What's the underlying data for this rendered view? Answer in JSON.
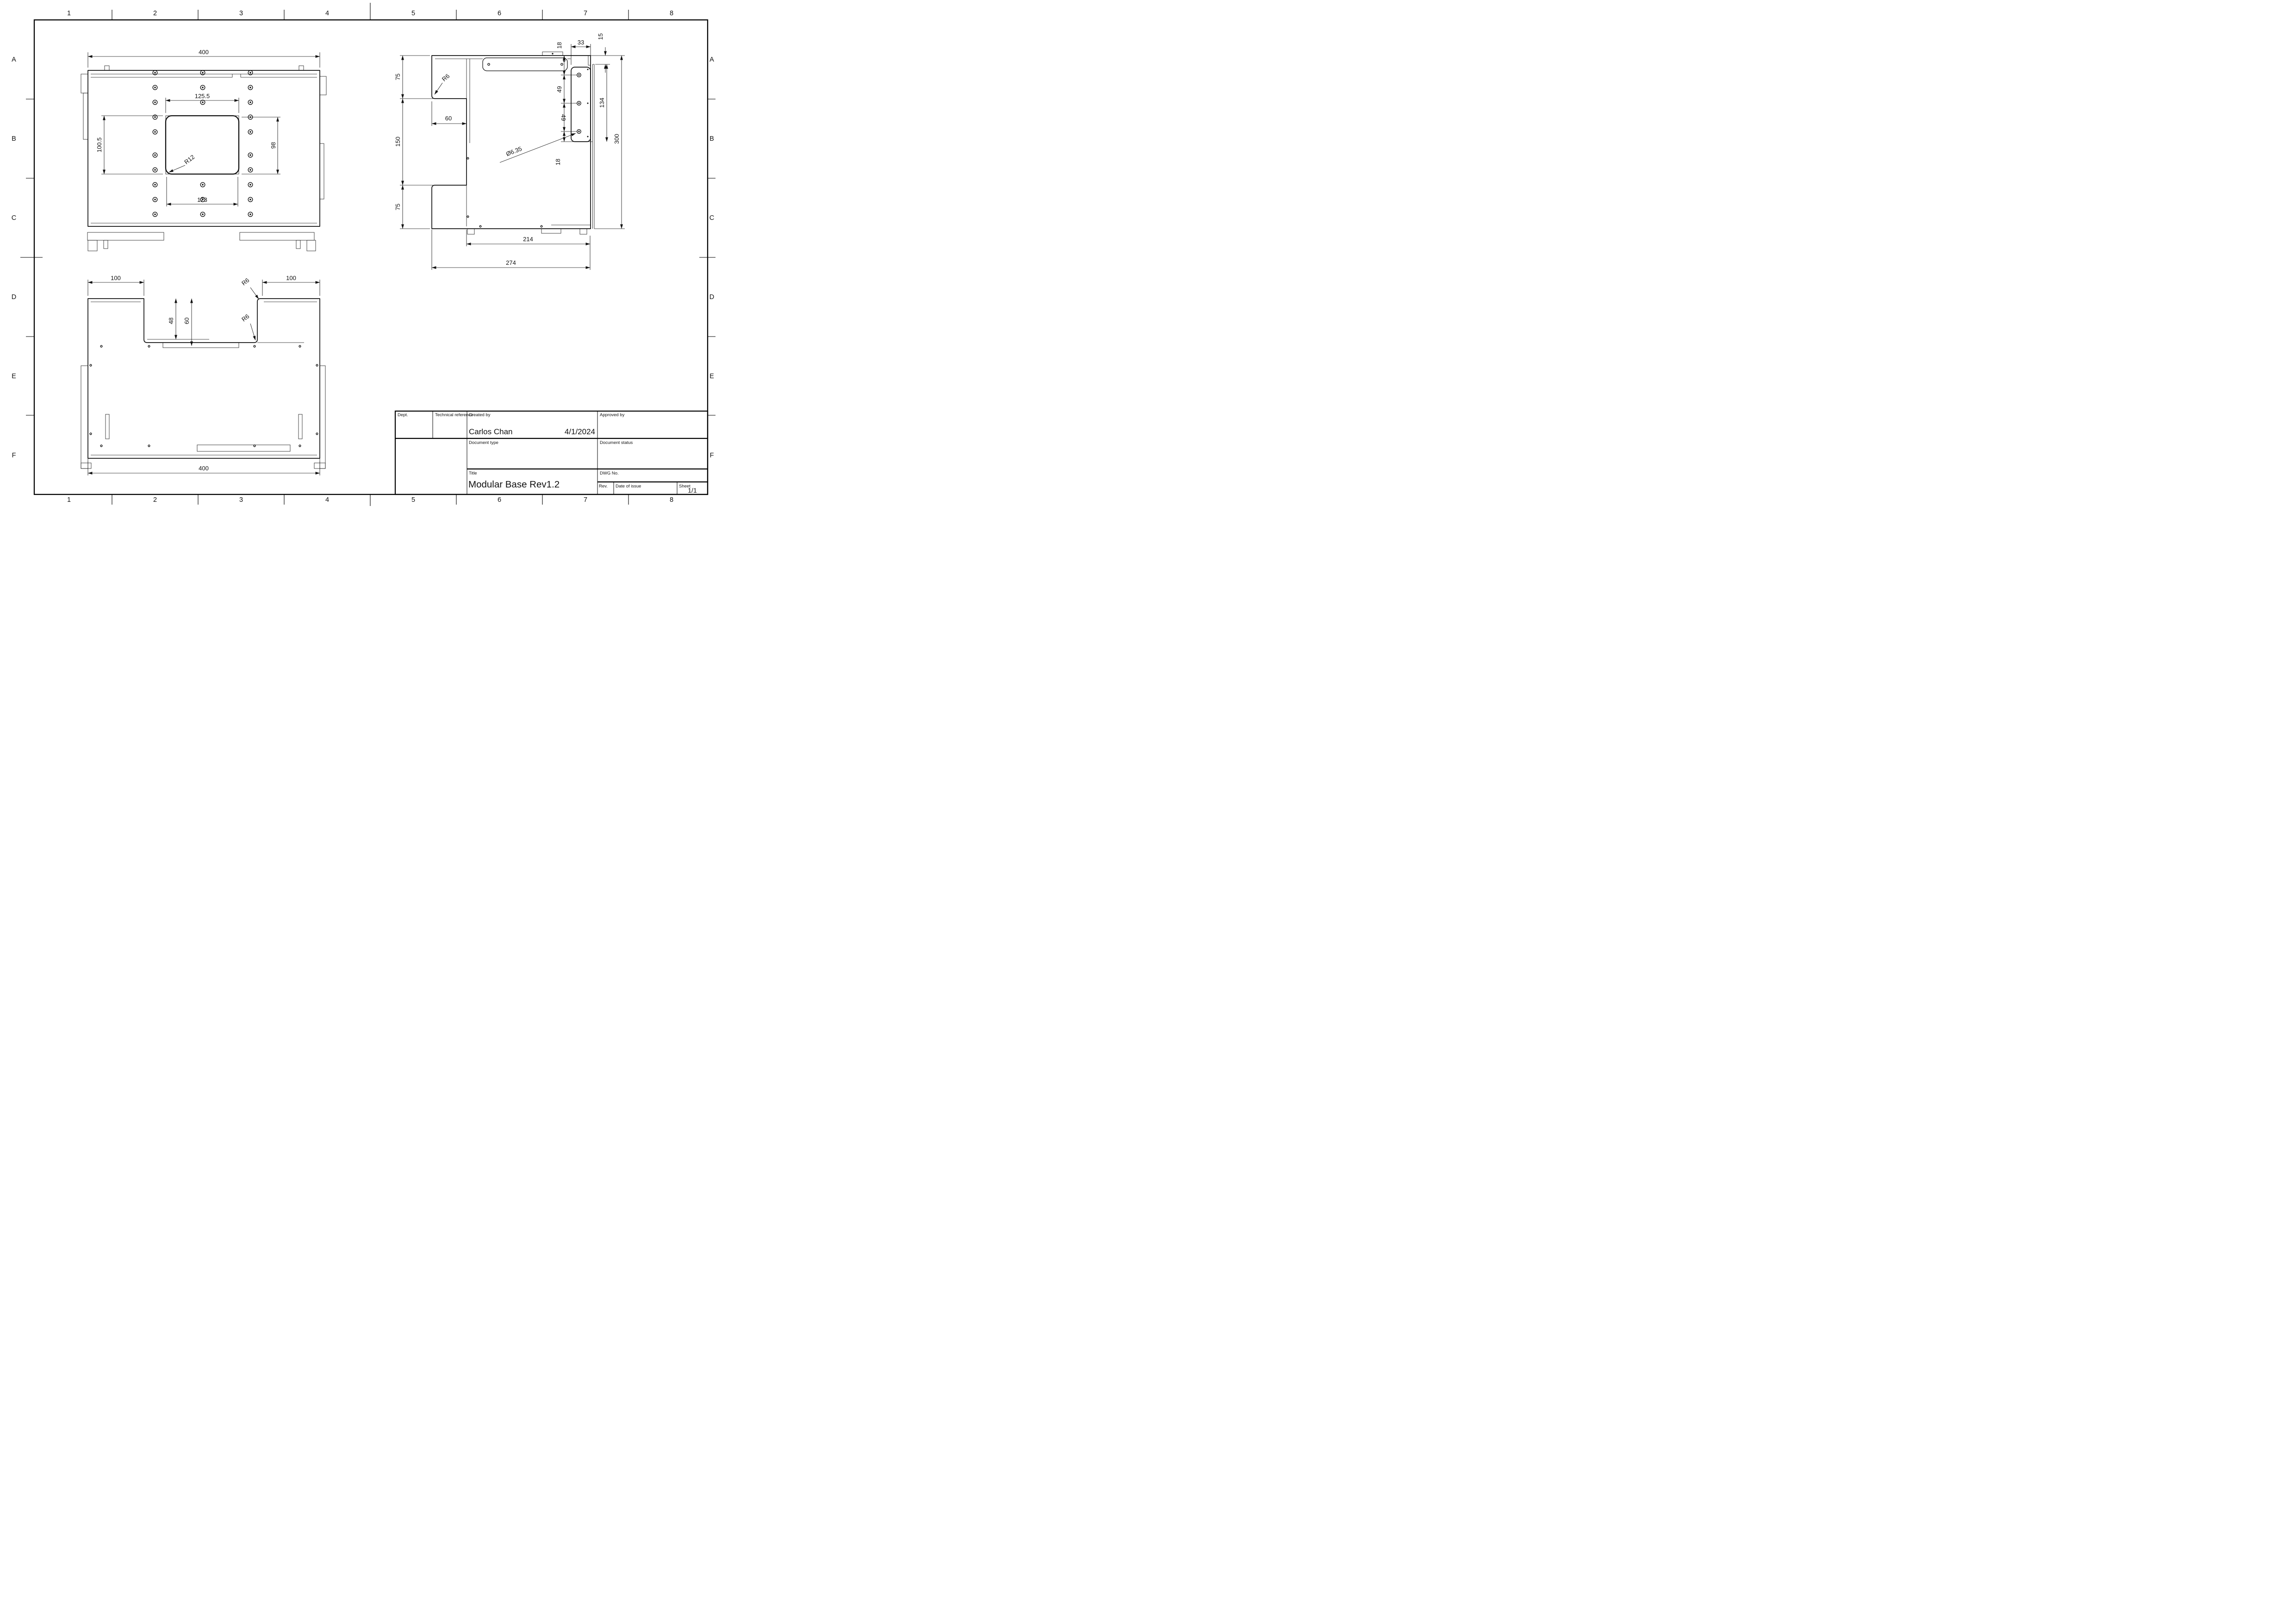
{
  "border": {
    "columns": [
      "1",
      "2",
      "3",
      "4",
      "5",
      "6",
      "7",
      "8"
    ],
    "rows": [
      "A",
      "B",
      "C",
      "D",
      "E",
      "F"
    ]
  },
  "title_block": {
    "dept_label": "Dept.",
    "technical_reference_label": "Technical reference",
    "created_by_label": "Created by",
    "approved_by_label": "Approved by",
    "created_by_name": "Carlos Chan",
    "created_date": "4/1/2024",
    "document_type_label": "Document type",
    "document_status_label": "Document status",
    "title_label": "Title",
    "title": "Modular Base Rev1.2",
    "dwg_no_label": "DWG No.",
    "rev_label": "Rev.",
    "date_of_issue_label": "Date of issue",
    "sheet_label": "Sheet",
    "sheet": "1/1"
  },
  "top_view": {
    "width": "400",
    "cutout_width_top": "125.5",
    "cutout_width_bottom": "123",
    "cutout_height_left": "100.5",
    "cutout_height_right": "98",
    "corner_radius": "R12"
  },
  "side_view": {
    "upper_height": "75",
    "middle_height": "150",
    "lower_height": "75",
    "notch_depth": "60",
    "notch_fillet": "R6",
    "hole_top_offset": "18",
    "bracket_width": "33",
    "top_offset": "15",
    "hole_pitch_upper": "49",
    "hole_pitch_lower": "49",
    "bracket_span": "134",
    "total_height": "300",
    "hole_diameter": "Ø6.35",
    "hole_bottom_offset": "18",
    "inner_depth": "214",
    "total_depth": "274"
  },
  "bottom_view": {
    "left_flange_width": "100",
    "right_flange_width": "100",
    "notch_depth_inner": "48",
    "notch_depth_outer": "60",
    "fillet_top": "R6",
    "fillet_bottom": "R6",
    "width": "400"
  }
}
